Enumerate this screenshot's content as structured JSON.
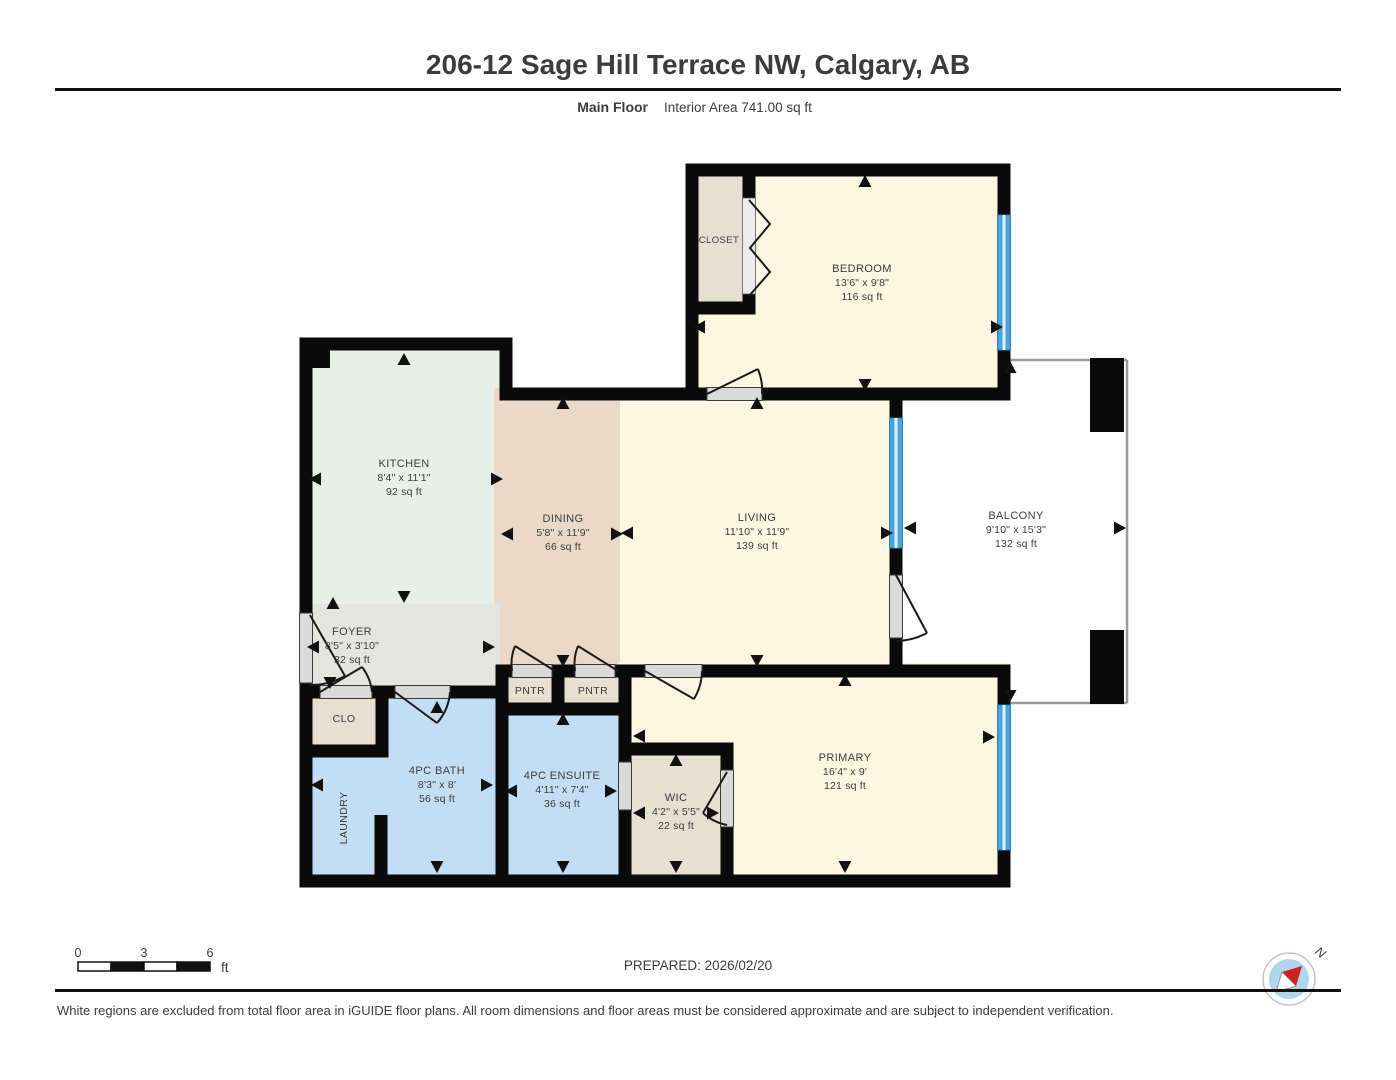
{
  "header": {
    "title": "206-12 Sage Hill Terrace NW, Calgary, AB",
    "floor_label": "Main Floor",
    "area_label": "Interior Area 741.00 sq ft"
  },
  "rooms": {
    "bedroom": {
      "name": "BEDROOM",
      "dims": "13'6\" x 9'8\"",
      "area": "116 sq ft"
    },
    "closet": {
      "name": "CLOSET"
    },
    "kitchen": {
      "name": "KITCHEN",
      "dims": "8'4\" x 11'1\"",
      "area": "92 sq ft"
    },
    "dining": {
      "name": "DINING",
      "dims": "5'8\" x 11'9\"",
      "area": "66 sq ft"
    },
    "living": {
      "name": "LIVING",
      "dims": "11'10\" x 11'9\"",
      "area": "139 sq ft"
    },
    "balcony": {
      "name": "BALCONY",
      "dims": "9'10\" x 15'3\"",
      "area": "132 sq ft"
    },
    "foyer": {
      "name": "FOYER",
      "dims": "8'5\" x 3'10\"",
      "area": "32 sq ft"
    },
    "clo": {
      "name": "CLO"
    },
    "pantry1": {
      "name": "PNTR"
    },
    "pantry2": {
      "name": "PNTR"
    },
    "laundry": {
      "name": "LAUNDRY"
    },
    "bath": {
      "name": "4PC BATH",
      "dims": "8'3\" x 8'",
      "area": "56 sq ft"
    },
    "ensuite": {
      "name": "4PC ENSUITE",
      "dims": "4'11\" x 7'4\"",
      "area": "36 sq ft"
    },
    "wic": {
      "name": "WIC",
      "dims": "4'2\" x 5'5\"",
      "area": "22 sq ft"
    },
    "primary": {
      "name": "PRIMARY",
      "dims": "16'4\" x 9'",
      "area": "121 sq ft"
    }
  },
  "footer": {
    "prepared": "PREPARED: 2026/02/20",
    "disclaimer": "White regions are excluded from total floor area in iGUIDE floor plans. All room dimensions and floor areas must be considered approximate and are subject to independent verification.",
    "scale": {
      "ticks": [
        "0",
        "3",
        "6"
      ],
      "unit": "ft"
    },
    "compass_label": "N"
  },
  "colors": {
    "wall": "#0a0a0a",
    "window": "#4aa3d9",
    "room_cream": "#fdf6e0",
    "room_mint": "#e8efe7",
    "room_tan": "#ead9c6",
    "room_beige": "#e7dfd2",
    "room_gray": "#e4e5e1",
    "room_blue": "#c3def4",
    "compass_red": "#cc2222",
    "compass_blue": "#aed6ec"
  }
}
